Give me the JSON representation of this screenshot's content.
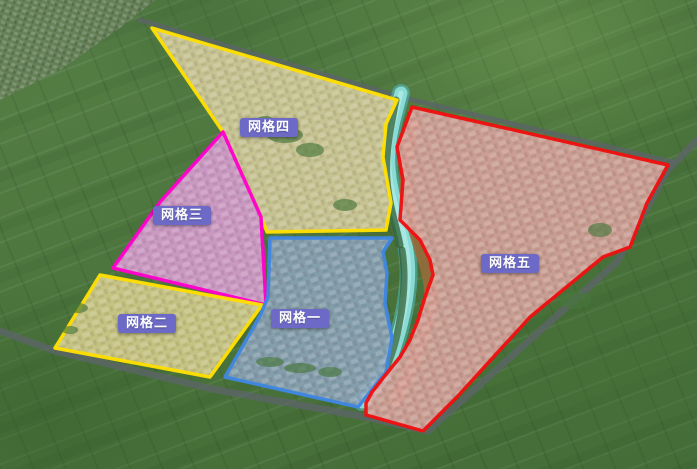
{
  "map_title": "grid-zones-aerial-map",
  "canvas": {
    "width": 697,
    "height": 469
  },
  "label_style": {
    "bg_color": "#6c6ac6",
    "text_color": "#ffffff"
  },
  "zones": [
    {
      "id": "grid-4",
      "label": "网格四",
      "outline_color": "#ffdf00",
      "fill_color": "#d8ce9e",
      "points": "152,28 397,100 386,124 383,157 391,203 386,230 267,232 261,217 223,132",
      "label_pos": {
        "x": 240,
        "y": 118
      }
    },
    {
      "id": "grid-3",
      "label": "网格三",
      "outline_color": "#ff00cc",
      "fill_color": "#dd9fd6",
      "points": "223,132 261,217 266,305 113,268 160,202",
      "label_pos": {
        "x": 153,
        "y": 206
      }
    },
    {
      "id": "grid-2",
      "label": "网格二",
      "outline_color": "#ffdf00",
      "fill_color": "#d8cf8e",
      "points": "100,275 262,305 210,377 55,348",
      "label_pos": {
        "x": 118,
        "y": 314
      }
    },
    {
      "id": "grid-1",
      "label": "网格一",
      "outline_color": "#3f86e0",
      "fill_color": "#8ea4bc",
      "points": "270,238 392,238 383,252 387,273 385,303 392,338 386,372 358,407 225,377 260,316 268,297",
      "label_pos": {
        "x": 271,
        "y": 309
      }
    },
    {
      "id": "grid-5",
      "label": "网格五",
      "outline_color": "#ee1111",
      "fill_color": "#dca4a0",
      "points": "412,107 668,165 647,203 630,247 603,257 530,317 457,397 423,431 366,415 366,403 372,392 383,378 400,357 410,340 418,320 425,297 433,275 430,260 420,240 400,220 403,180 397,147",
      "label_pos": {
        "x": 481,
        "y": 254
      }
    }
  ],
  "river": {
    "path": "M401,93 C395,118 387,140 389,168 C391,196 399,212 404,235 C409,258 410,272 407,295 C404,318 398,338 391,358 C385,375 376,388 362,402",
    "color": "#8fe0dc",
    "edge_color": "#4fb8b4",
    "highlight_color": "#c6f4f0"
  },
  "roads": [
    {
      "id": "north-road",
      "path": "M140,20 L400,97 L672,162",
      "width": 5
    },
    {
      "id": "south-road",
      "path": "M0,331 L55,351 L212,389 L300,405 L360,416 L428,431 L617,262 L668,170 L697,140",
      "width": 7
    }
  ],
  "trees": {
    "west_bank_color": "#2f5a2c",
    "east_bank_color": "#9c6b3c",
    "west_paths": [
      "M396,100 C390,130 385,155 387,180 C389,205 396,225 400,245",
      "M402,250 C406,275 404,300 399,325 C395,348 388,368 375,388"
    ],
    "east_paths": [
      "M413,125 C404,155 404,185 409,210 C415,235 424,255 429,278 C433,300 428,325 419,348 C412,368 404,385 396,400"
    ]
  },
  "village_patch": {
    "points": "0,0 155,0 120,28 60,70 0,100",
    "color": "#77856a"
  }
}
